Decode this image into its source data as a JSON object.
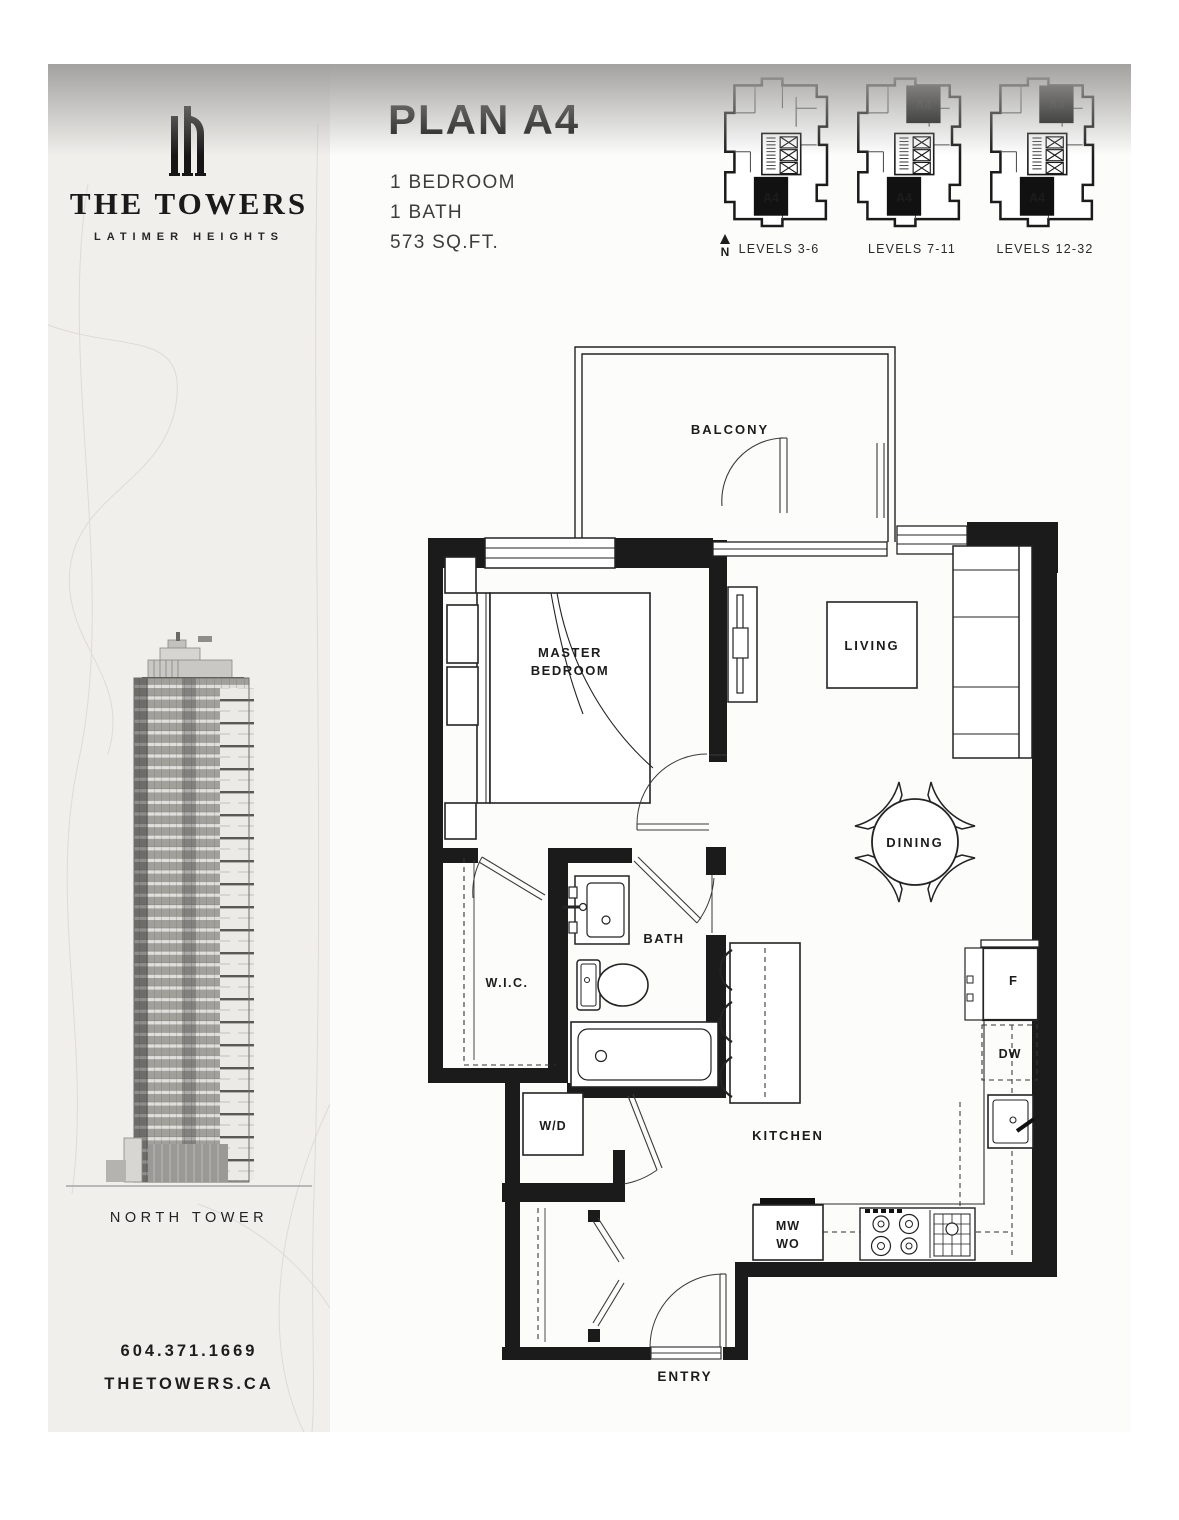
{
  "header": {
    "plan_title": "PLAN A4",
    "specs": [
      "1 BEDROOM",
      "1 BATH",
      "573 SQ.FT."
    ]
  },
  "keyplans": {
    "north_label": "N",
    "unit_label": "A4",
    "items": [
      {
        "label": "LEVELS 3-6",
        "a4_top": false,
        "a4_bottom": true
      },
      {
        "label": "LEVELS 7-11",
        "a4_top": true,
        "a4_bottom": true
      },
      {
        "label": "LEVELS 12-32",
        "a4_top": true,
        "a4_bottom": true
      }
    ]
  },
  "sidebar": {
    "brand_name": "THE TOWERS",
    "brand_subtitle": "LATIMER HEIGHTS",
    "tower_caption": "NORTH TOWER",
    "phone": "604.371.1669",
    "website": "THETOWERS.CA",
    "background": "#f0efec"
  },
  "floorplan": {
    "wall_color": "#1b1b1b",
    "rooms": {
      "balcony": "BALCONY",
      "master_bedroom_line1": "MASTER",
      "master_bedroom_line2": "BEDROOM",
      "living": "LIVING",
      "dining": "DINING",
      "wic": "W.I.C.",
      "bath": "BATH",
      "wd": "W/D",
      "kitchen": "KITCHEN",
      "entry": "ENTRY"
    },
    "appliances": {
      "fridge": "F",
      "dishwasher": "DW",
      "microwave": "MW",
      "wall_oven": "WO"
    }
  }
}
